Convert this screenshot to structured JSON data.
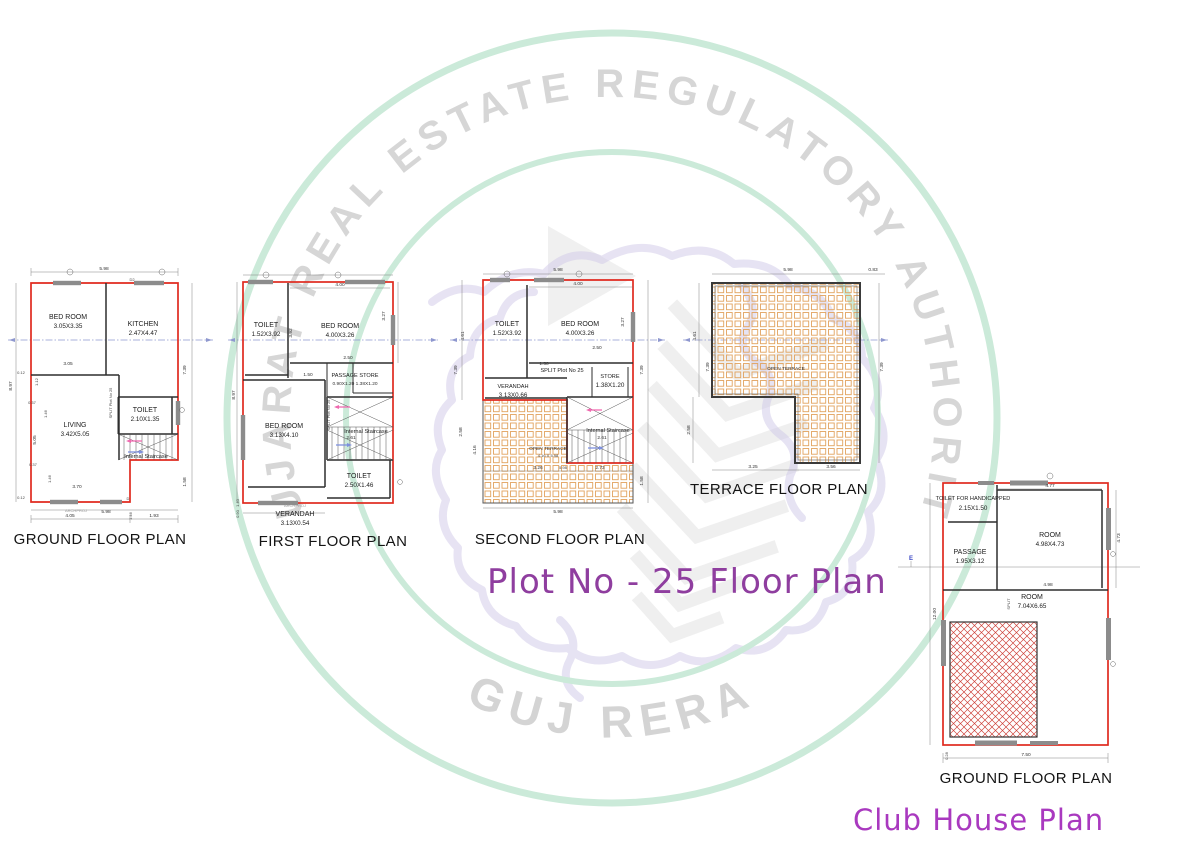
{
  "watermark": {
    "ring_text": "GUJARAT REAL ESTATE REGULATORY AUTHORITY",
    "bottom_text": "GUJ RERA",
    "ring_color": "#cbead9",
    "text_color": "#d6d6d6"
  },
  "headings": {
    "plot_title": "Plot No - 25 Floor Plan",
    "plot_title_color": "#8f3e9f",
    "club_title": "Club House Plan",
    "club_title_color": "#a939bf"
  },
  "ground": {
    "title": "GROUND FLOOR PLAN",
    "rooms": {
      "bedroom": {
        "name": "BED ROOM",
        "size": "3.05X3.35"
      },
      "kitchen": {
        "name": "KITCHEN",
        "size": "2.47X4.47"
      },
      "living": {
        "name": "LIVING",
        "size": "3.42X5.05"
      },
      "toilet": {
        "name": "TOILET",
        "size": "2.10X1.35"
      }
    },
    "staircase": "Internal Staircase",
    "split": "SPLIT Plot No 25",
    "archproj": "ARCHPROJ",
    "doors": {
      "d2": "D2",
      "d": "D"
    },
    "dims": {
      "top": "5.98",
      "left": "8.97",
      "right": "7.39",
      "right_bottom": "1.58",
      "w1": "0.12",
      "w2": "3.05",
      "w3": "1.12",
      "w4": "0.37",
      "w5": "1.46",
      "w6": "5.05",
      "w7": "3.70",
      "w8": "0.37",
      "w9": "1.46",
      "w10": "0.12",
      "bottom1": "5.98",
      "bottom2": "4.05",
      "bottom3": "1.93",
      "b_small": "1.46"
    }
  },
  "first": {
    "title": "FIRST FLOOR PLAN",
    "rooms": {
      "toilet1": {
        "name": "TOILET",
        "size": "1.52X3.92"
      },
      "bedroom1": {
        "name": "BED ROOM",
        "size": "4.00X3.26"
      },
      "passage_store": {
        "name": "PASSAGE STORE",
        "size": "0.90X1.20 1.38X1.20"
      },
      "bedroom2": {
        "name": "BED ROOM",
        "size": "3.13X4.10"
      },
      "toilet2": {
        "name": "TOILET",
        "size": "2.50X1.46"
      },
      "verandah": {
        "name": "VERANDAH",
        "size": "3.13X0.54"
      }
    },
    "staircase": "Internal Staircase",
    "split": "SPLIT Plot No 25",
    "archproj": "ARCHPROJ",
    "dims": {
      "top": "4.00",
      "left": "8.97",
      "toilet_h": "3.92",
      "right": "3.27",
      "m1": "2.50",
      "m2": "1.50",
      "m3": "2.61",
      "bl1": "1.40",
      "bl2": "0.90"
    }
  },
  "second": {
    "title": "SECOND FLOOR PLAN",
    "rooms": {
      "toilet": {
        "name": "TOILET",
        "size": "1.52X3.92"
      },
      "bedroom": {
        "name": "BED ROOM",
        "size": "4.00X3.26"
      },
      "store": {
        "name": "STORE",
        "size": "1.38X1.20"
      },
      "verandah": {
        "name": "VERANDAH",
        "size": "3.13X0.66"
      },
      "terrace": {
        "name": "OPEN TERRACE",
        "size": "4.16 X 5.98"
      }
    },
    "staircase": "Internal Staircase",
    "split": "SPLIT Plot No 25",
    "dims": {
      "top": "5.98",
      "top2": "4.00",
      "l1": "4.61",
      "l2": "7.39",
      "l3": "2.58",
      "l4": "4.16",
      "r1": "3.27",
      "r2": "7.39",
      "r3": "1.58",
      "m1": "2.50",
      "m2": "1.50",
      "m3": "2.61",
      "b1": "3.26",
      "b2": "5.98",
      "b3": "2.73",
      "bottom": "5.98"
    }
  },
  "terrace": {
    "title": "TERRACE FLOOR PLAN",
    "label": "OPEN TERRACE",
    "dims": {
      "top": "5.98",
      "top_right": "0.83",
      "l1": "4.61",
      "l2": "7.39",
      "l3": "2.58",
      "r1": "7.39",
      "b1": "3.25",
      "b2": "3.56"
    }
  },
  "club": {
    "title": "GROUND FLOOR PLAN",
    "rooms": {
      "toilet": {
        "name": "TOILET FOR HANDICAPPED",
        "size": "2.15X1.50"
      },
      "room1": {
        "name": "ROOM",
        "size": "4.98X4.73"
      },
      "passage": {
        "name": "PASSAGE",
        "size": "1.95X3.12"
      },
      "room2": {
        "name": "ROOM",
        "size": "7.04X6.65"
      }
    },
    "split": "SPLIT",
    "grid_label": "E",
    "dims": {
      "top": "4.77",
      "right": "4.73",
      "mid": "4.98",
      "left": "12.00",
      "bottom": "7.50",
      "bottom_left": "0.28"
    }
  }
}
